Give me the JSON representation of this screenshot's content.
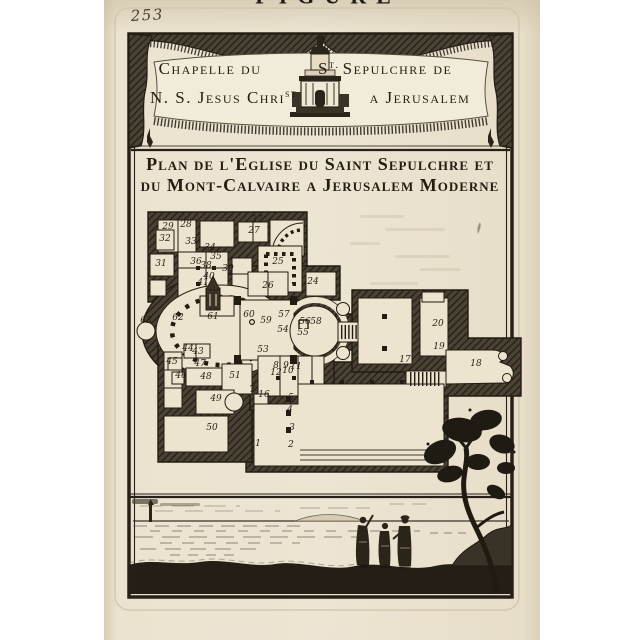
{
  "page": {
    "number": "253",
    "top_cropped_text": "FIGURE"
  },
  "banner": {
    "line1_left": "Chapelle du",
    "line1_right_s": "S",
    "line1_right_sup": "t.",
    "line1_right_rest": "Sepulchre de",
    "line2_left": "N. S. Jesus Chri",
    "line2_left_sup": "st",
    "line2_right": "a Jerusalem"
  },
  "title": {
    "line1": "Plan de l'Eglise du Saint Sepulchre et",
    "line2": "du Mont-Calvaire a Jerusalem Moderne"
  },
  "plan": {
    "labels": [
      {
        "n": "29",
        "x": 168,
        "y": 229
      },
      {
        "n": "28",
        "x": 186,
        "y": 227
      },
      {
        "n": "37",
        "x": 257,
        "y": 222
      },
      {
        "n": "27",
        "x": 254,
        "y": 233
      },
      {
        "n": "32",
        "x": 165,
        "y": 241
      },
      {
        "n": "33",
        "x": 191,
        "y": 244
      },
      {
        "n": "34",
        "x": 210,
        "y": 250
      },
      {
        "n": "35",
        "x": 216,
        "y": 259
      },
      {
        "n": "31",
        "x": 161,
        "y": 266
      },
      {
        "n": "36",
        "x": 196,
        "y": 264
      },
      {
        "n": "38",
        "x": 206,
        "y": 268
      },
      {
        "n": "39",
        "x": 228,
        "y": 271
      },
      {
        "n": "25",
        "x": 278,
        "y": 264
      },
      {
        "n": "40",
        "x": 209,
        "y": 279
      },
      {
        "n": "41",
        "x": 203,
        "y": 285
      },
      {
        "n": "24",
        "x": 313,
        "y": 284
      },
      {
        "n": "26",
        "x": 268,
        "y": 288
      },
      {
        "n": "63",
        "x": 146,
        "y": 323
      },
      {
        "n": "62",
        "x": 178,
        "y": 320
      },
      {
        "n": "61",
        "x": 213,
        "y": 319
      },
      {
        "n": "60",
        "x": 249,
        "y": 317
      },
      {
        "n": "59",
        "x": 266,
        "y": 323
      },
      {
        "n": "57",
        "x": 284,
        "y": 317
      },
      {
        "n": "54",
        "x": 283,
        "y": 332
      },
      {
        "n": "56",
        "x": 305,
        "y": 324
      },
      {
        "n": "58",
        "x": 316,
        "y": 324
      },
      {
        "n": "55",
        "x": 303,
        "y": 335
      },
      {
        "n": "53",
        "x": 263,
        "y": 352
      },
      {
        "n": "20",
        "x": 438,
        "y": 326
      },
      {
        "n": "19",
        "x": 439,
        "y": 349
      },
      {
        "n": "17",
        "x": 405,
        "y": 362
      },
      {
        "n": "18",
        "x": 476,
        "y": 366
      },
      {
        "n": "44",
        "x": 188,
        "y": 351
      },
      {
        "n": "43",
        "x": 198,
        "y": 354
      },
      {
        "n": "45",
        "x": 172,
        "y": 364
      },
      {
        "n": "47",
        "x": 200,
        "y": 366
      },
      {
        "n": "46",
        "x": 181,
        "y": 378
      },
      {
        "n": "48",
        "x": 206,
        "y": 379
      },
      {
        "n": "51",
        "x": 235,
        "y": 378
      },
      {
        "n": "49",
        "x": 216,
        "y": 401
      },
      {
        "n": "50",
        "x": 212,
        "y": 430
      },
      {
        "n": "8",
        "x": 276,
        "y": 368
      },
      {
        "n": "9",
        "x": 286,
        "y": 368
      },
      {
        "n": "11",
        "x": 296,
        "y": 369
      },
      {
        "n": "10",
        "x": 288,
        "y": 373
      },
      {
        "n": "12",
        "x": 276,
        "y": 375
      },
      {
        "n": "7",
        "x": 252,
        "y": 392
      },
      {
        "n": "16",
        "x": 264,
        "y": 397
      },
      {
        "n": "5",
        "x": 291,
        "y": 400
      },
      {
        "n": "4",
        "x": 290,
        "y": 412
      },
      {
        "n": "3",
        "x": 292,
        "y": 430
      },
      {
        "n": "1",
        "x": 258,
        "y": 446
      },
      {
        "n": "2",
        "x": 291,
        "y": 447
      }
    ]
  },
  "colors": {
    "paper": "#ece4d1",
    "ink": "#241d13",
    "wall_hatch": "#4a4335"
  }
}
